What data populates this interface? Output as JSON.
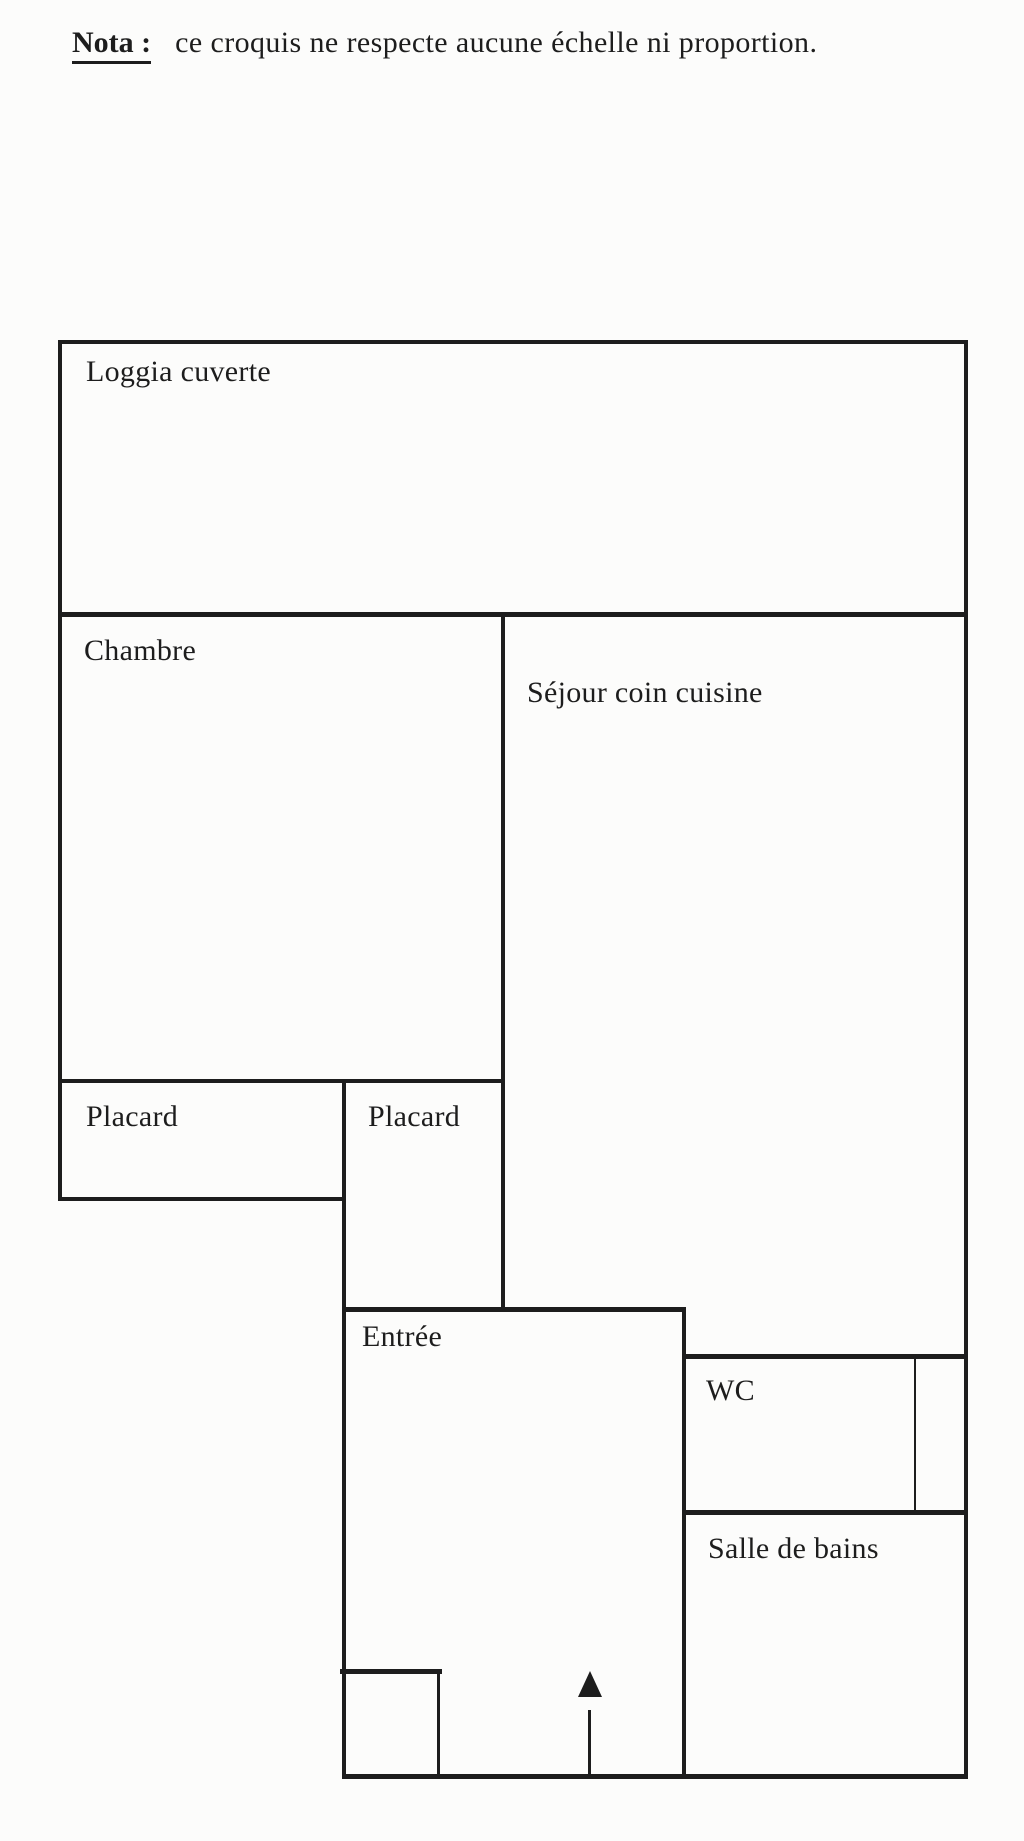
{
  "note": {
    "label": "Nota :",
    "text": "ce croquis ne respecte aucune échelle ni proportion."
  },
  "rooms": {
    "loggia": "Loggia cuverte",
    "chambre": "Chambre",
    "sejour": "Séjour coin cuisine",
    "placard_left": "Placard",
    "placard_right": "Placard",
    "entree": "Entrée",
    "wc": "WC",
    "salle_de_bains": "Salle de bains"
  },
  "icons": {
    "entrance_arrow": "up-arrow"
  },
  "colors": {
    "ink": "#1d1d1d",
    "paper": "#fcfcfb"
  }
}
